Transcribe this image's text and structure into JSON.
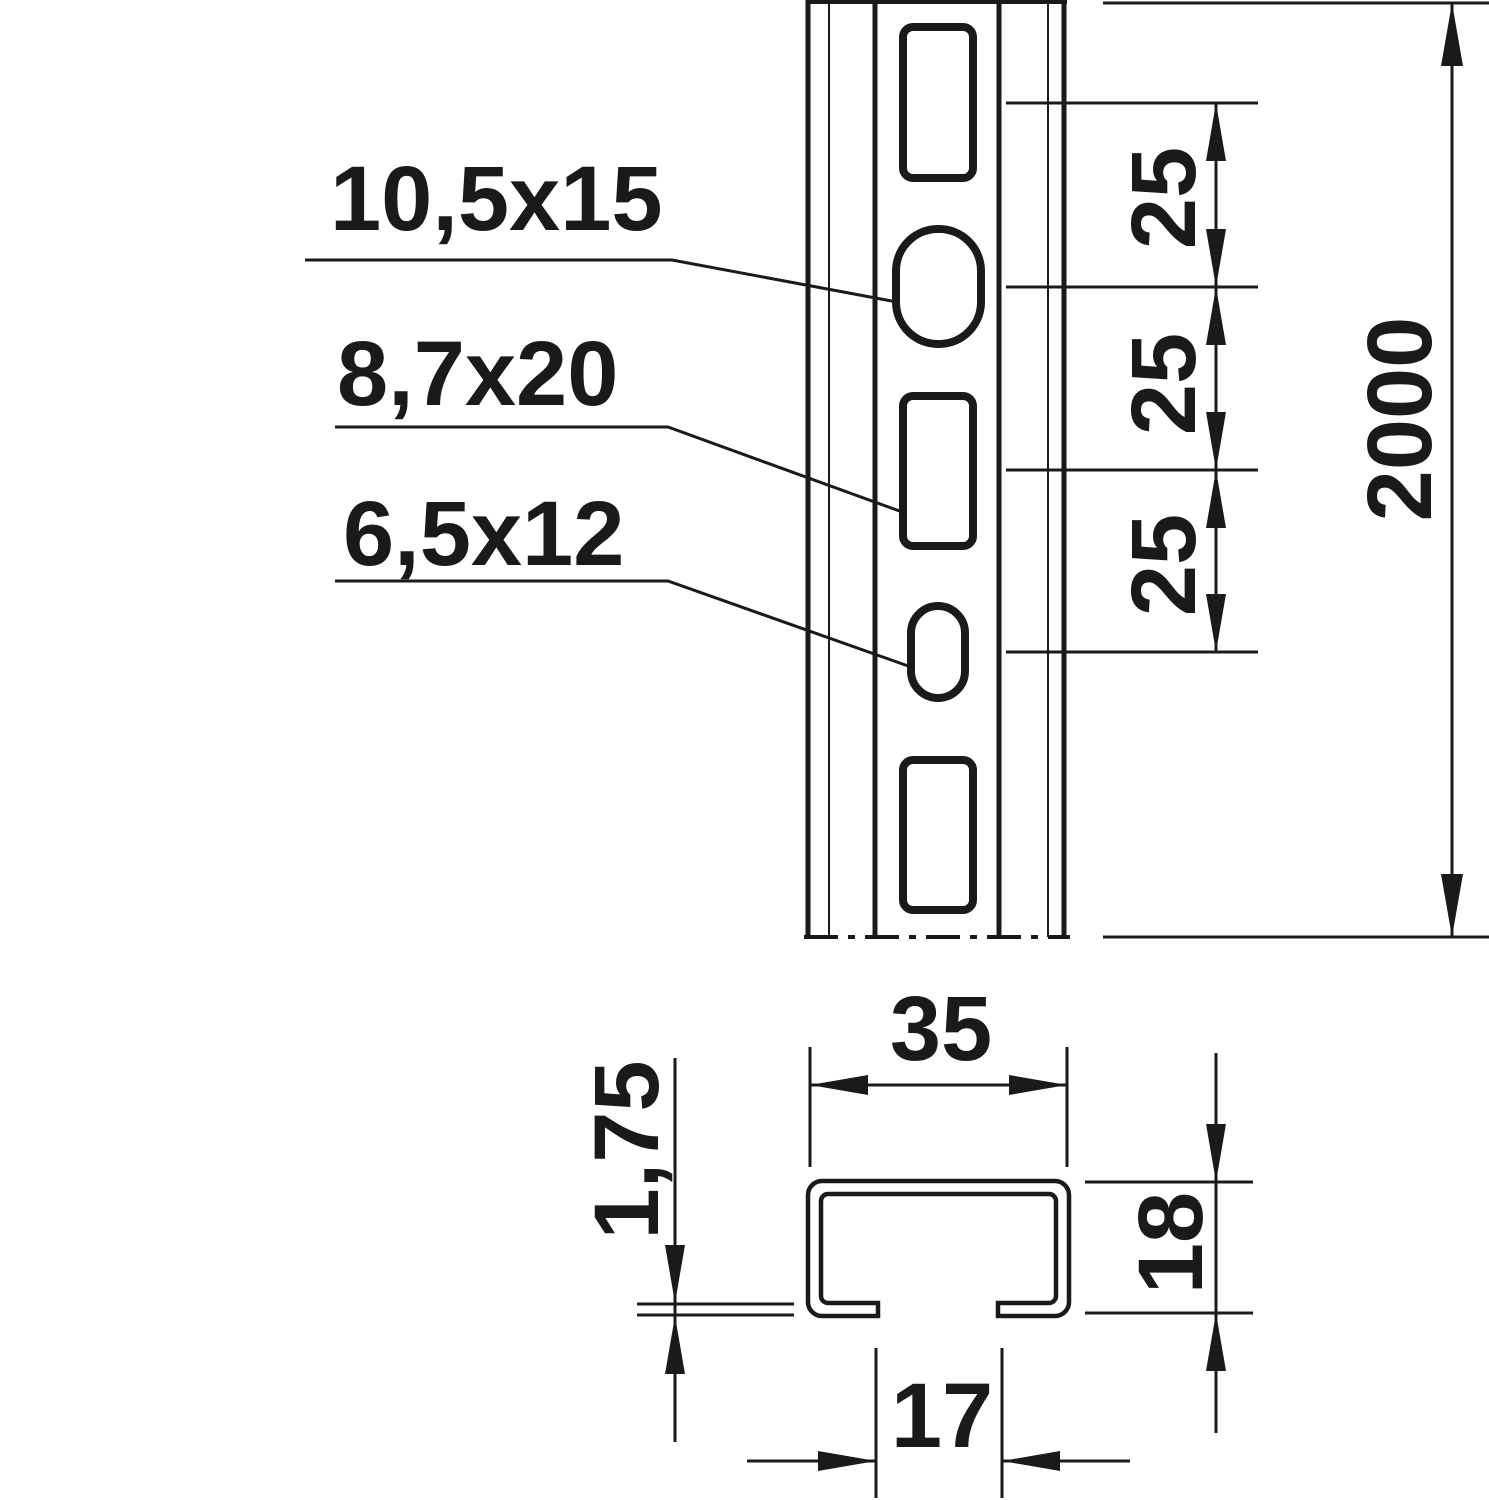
{
  "title": "C-profile rail dimension drawing",
  "front_view": {
    "hole_labels": [
      {
        "text": "10,5x15"
      },
      {
        "text": "8,7x20"
      },
      {
        "text": "6,5x12"
      }
    ],
    "pitch_dims": [
      "25",
      "25",
      "25"
    ],
    "length_dim": "2000"
  },
  "cross_section": {
    "width_dim": "35",
    "thickness_dim": "1,75",
    "height_dim": "18",
    "opening_dim": "17"
  },
  "colors": {
    "ink": "#1a1a1a",
    "paper": "#ffffff"
  }
}
